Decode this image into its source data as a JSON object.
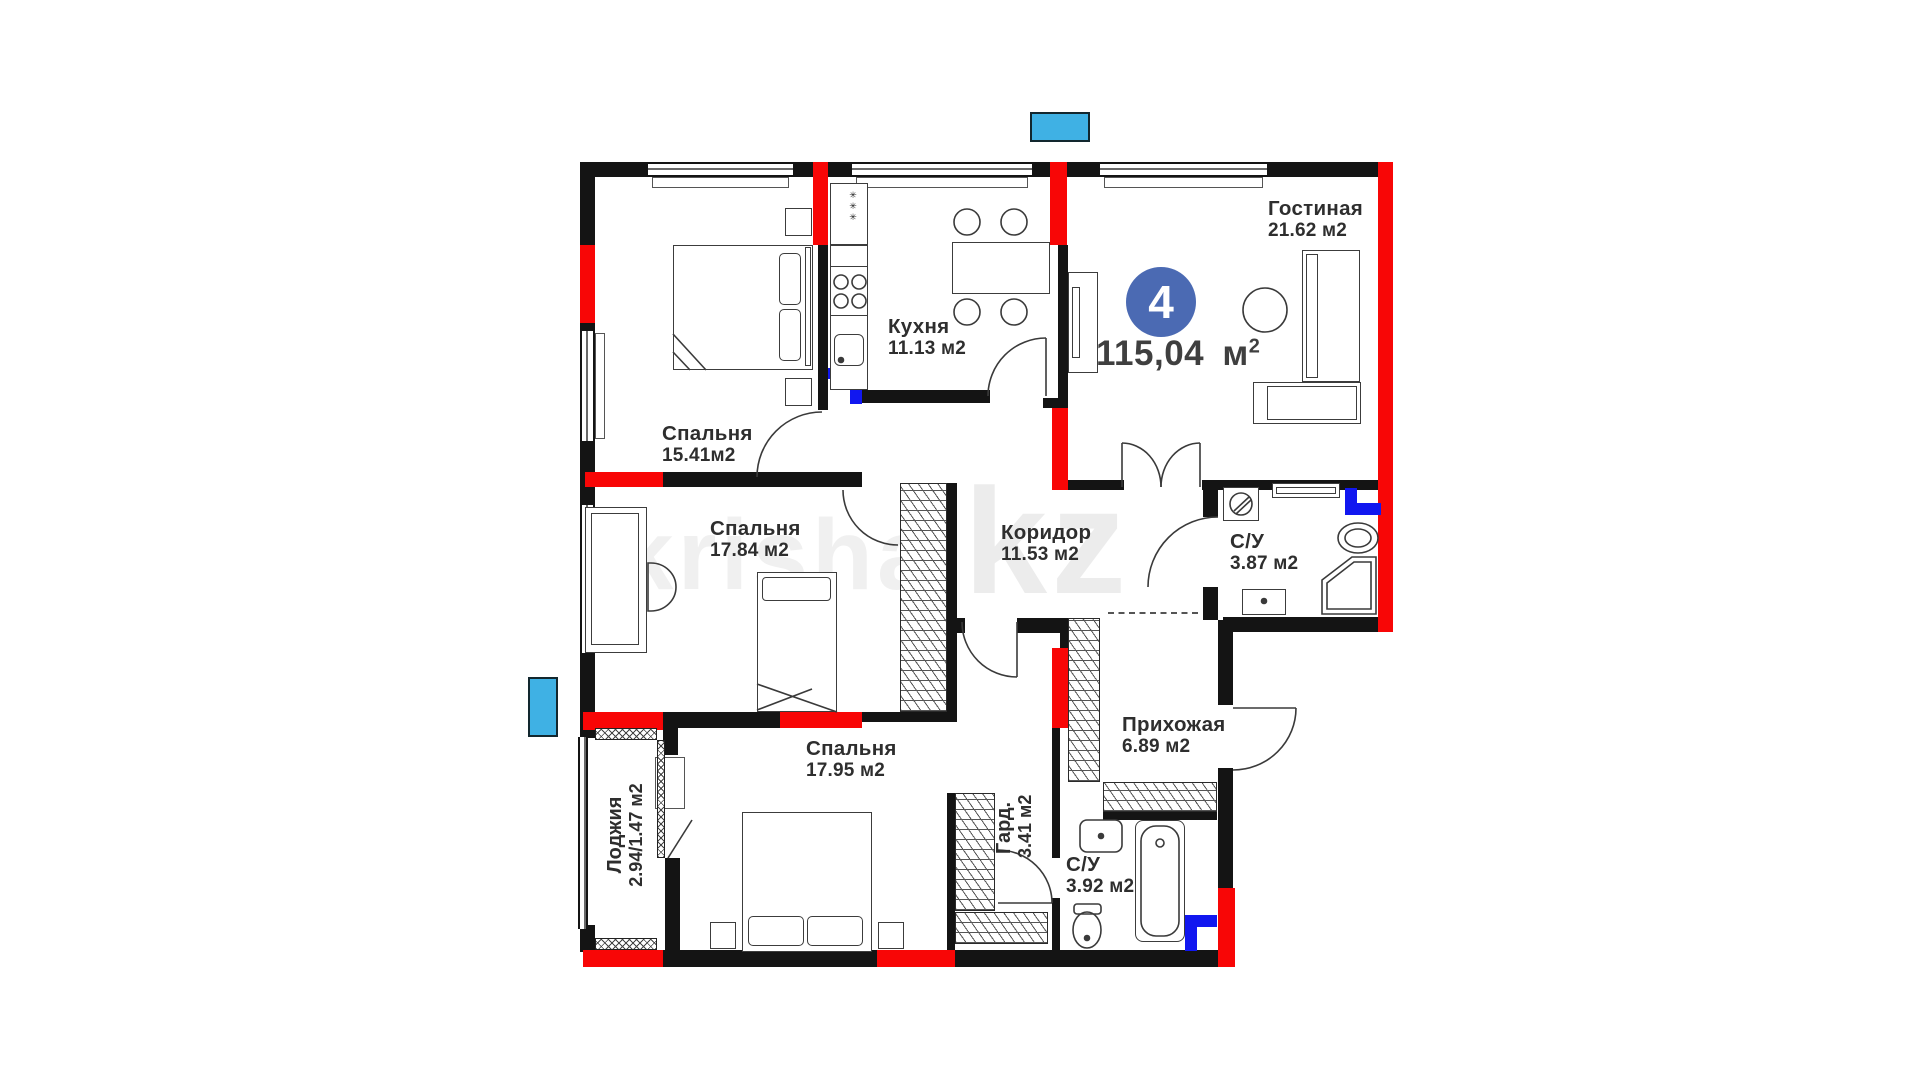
{
  "plan": {
    "badge": {
      "number": "4",
      "area_value": "115,04",
      "area_unit": "м",
      "area_sup": "2"
    },
    "watermark": {
      "left": "krisha",
      "right": ".kz"
    },
    "kitchen_vent_symbol": "✳✳✳",
    "rooms": {
      "living": {
        "name": "Гостиная",
        "area": "21.62 м2"
      },
      "kitchen": {
        "name": "Кухня",
        "area": "11.13 м2"
      },
      "bedroom1": {
        "name": "Спальня",
        "area": "15.41м2"
      },
      "bedroom2": {
        "name": "Спальня",
        "area": "17.84 м2"
      },
      "bedroom3": {
        "name": "Спальня",
        "area": "17.95 м2"
      },
      "corridor": {
        "name": "Коридор",
        "area": "11.53 м2"
      },
      "bathroom1": {
        "name": "С/У",
        "area": "3.87 м2"
      },
      "bathroom2": {
        "name": "С/У",
        "area": "3.92 м2"
      },
      "hallway": {
        "name": "Прихожая",
        "area": "6.89 м2"
      },
      "wardrobe": {
        "name": "Гард.",
        "area": "3.41 м2"
      },
      "loggia": {
        "name": "Лоджия",
        "area": "2.94/1.47 м2"
      }
    },
    "colors": {
      "wall": "#141414",
      "red": "#f80606",
      "plumbing": "#1117f0",
      "vent_fill": "#3fb1e4",
      "vent_border": "#12272e",
      "badge_bg": "#4b6ab3",
      "label": "#2e2e2e"
    }
  }
}
